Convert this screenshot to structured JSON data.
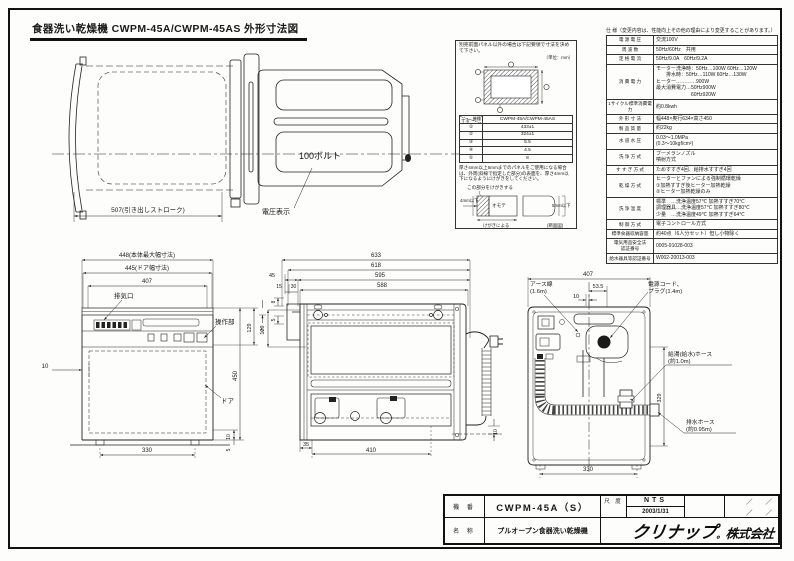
{
  "sheet": {
    "title": "食器洗い乾燥機 CWPM-45A/CWPM-45AS 外形寸法図"
  },
  "spec": {
    "title": "仕 様（変更内容は、性能向上その他の理由により変更することがあります。）",
    "rows": [
      {
        "label": "電 源 電 圧",
        "value": "交流100V"
      },
      {
        "label": "周 波 数",
        "value": "50Hz/60Hz　共用"
      },
      {
        "label": "定 格 電 流",
        "value": "50Hz/9.0A　60Hz/9.2A"
      },
      {
        "label": "消 費 電 力",
        "value": "モーター洗浄時：50Hz…100W 60Hz…120W\n　　排水時：50Hz…110W 60Hz…130W\nヒーター…………900W\n最大消費電力…50Hz900W\n　　　　　　　60Hz920W"
      },
      {
        "label": "1サイクル標準消費電力",
        "value": "約0.8kwh"
      },
      {
        "label": "外 形 寸 法",
        "value": "幅448×奥行634×高さ450"
      },
      {
        "label": "製 品 質 量",
        "value": "約22kg"
      },
      {
        "label": "水 道 水 圧",
        "value": "0.03～1.0MPa\n(0.3～10kgf/cm²)"
      },
      {
        "label": "洗 浄 方 式",
        "value": "ブーメランノズル\n噴射方式"
      },
      {
        "label": "す す ぎ 方 式",
        "value": "ためすすぎ4回、給排水すすぎ4回"
      },
      {
        "label": "乾 燥 方 式",
        "value": "ヒーターとファンによる強制循環乾燥\n①加熱すすぎ後ヒーター加熱乾燥\n②ヒーター加熱乾燥のみ"
      },
      {
        "label": "洗 浄 温 度",
        "value": "標準　…洗浄温度57℃ 加熱すすぎ70℃\n調理器具…洗浄温度57℃ 加熱すすぎ80℃\n少量　…洗浄温度49℃ 加熱すすぎ64℃"
      },
      {
        "label": "制 御 方 式",
        "value": "電子コントロール方式"
      },
      {
        "label": "標準食器収納容量",
        "value": "約40点（6人分セット）但し小物除く"
      },
      {
        "label": "電気用品安全法\n認証番号",
        "value": "0005-91028-003"
      },
      {
        "label": "給水器具等認証番号",
        "value": "W002-20013-003"
      }
    ]
  },
  "inset": {
    "note1": "別売前面パネル以外の場合は下記要領で寸法を決めて下さい。",
    "unit": "（単位：mm）",
    "header_model": "CWPM-45A/CWPM-45AS",
    "header_dim": "寸法",
    "header_type": "機種",
    "rows": [
      {
        "mark": "①",
        "value": "433±1"
      },
      {
        "mark": "②",
        "value": "324±1"
      },
      {
        "mark": "③",
        "value": "5.5"
      },
      {
        "mark": "④",
        "value": "4.5"
      },
      {
        "mark": "⑤",
        "value": "8"
      }
    ],
    "note2": "厚さ4mm以上5mmまでのパネルをご使用になる場合は、外周(斜線で指定した部分)の表面を、厚さ4mm以下になるようにけがきをしてください。",
    "sec_kegaki": "この部分をけがきする",
    "sec_omote": "オモテ",
    "sec_4mm": "4mm以下",
    "sec_5mm": "5mm以下",
    "sec_by": "けがきによる",
    "sec_name": "(断面図)"
  },
  "plan": {
    "dim507": "507(引き出しストローク)",
    "volt": "100ボルト",
    "volt_label": "電圧表示"
  },
  "front": {
    "dim448": "448(本体最大幅寸法)",
    "dim445": "445(ドア幅寸法)",
    "dim407": "407",
    "haikiko": "排気口",
    "sousabu": "操作部",
    "door": "ドア",
    "dim10l": "10",
    "dim450": "450",
    "dim129": "129",
    "dim5t": "5",
    "dim10b": "10",
    "dim5b": "5",
    "dim330": "330"
  },
  "side": {
    "dim633": "633",
    "dim618": "618",
    "dim595": "595",
    "dim588": "588",
    "dim45": "45",
    "dim15": "15",
    "dim30": "30",
    "dim8": "8",
    "dim5": "5",
    "dim129": "129",
    "dim35": "35",
    "dim410": "410",
    "dim10": "10"
  },
  "rear": {
    "dim407": "407",
    "dim53": "53.5",
    "dim10": "10",
    "earth1": "アース線",
    "earth2": "(1.6m)",
    "cord1": "電源コード、",
    "cord2": "プラグ(1.4m)",
    "hose1a": "給湯(給水)ホース",
    "hose1b": "(約1.0m)",
    "hose2a": "排水ホース",
    "hose2b": "(約0.95m)",
    "dim329": "329",
    "dim330": "330"
  },
  "block": {
    "model_label": "機 番",
    "model": "CWPM-45A（S）",
    "scale_label": "尺 度",
    "scale": "NTS",
    "date": "2003/1/31",
    "slash_a": "／　　／",
    "slash_b": "／　　／",
    "name_label": "名 称",
    "name": "プルオープン食器洗い乾燥機",
    "logo_main": "クリナップ",
    "logo_dot": "。",
    "logo_sub": "株式会社"
  }
}
